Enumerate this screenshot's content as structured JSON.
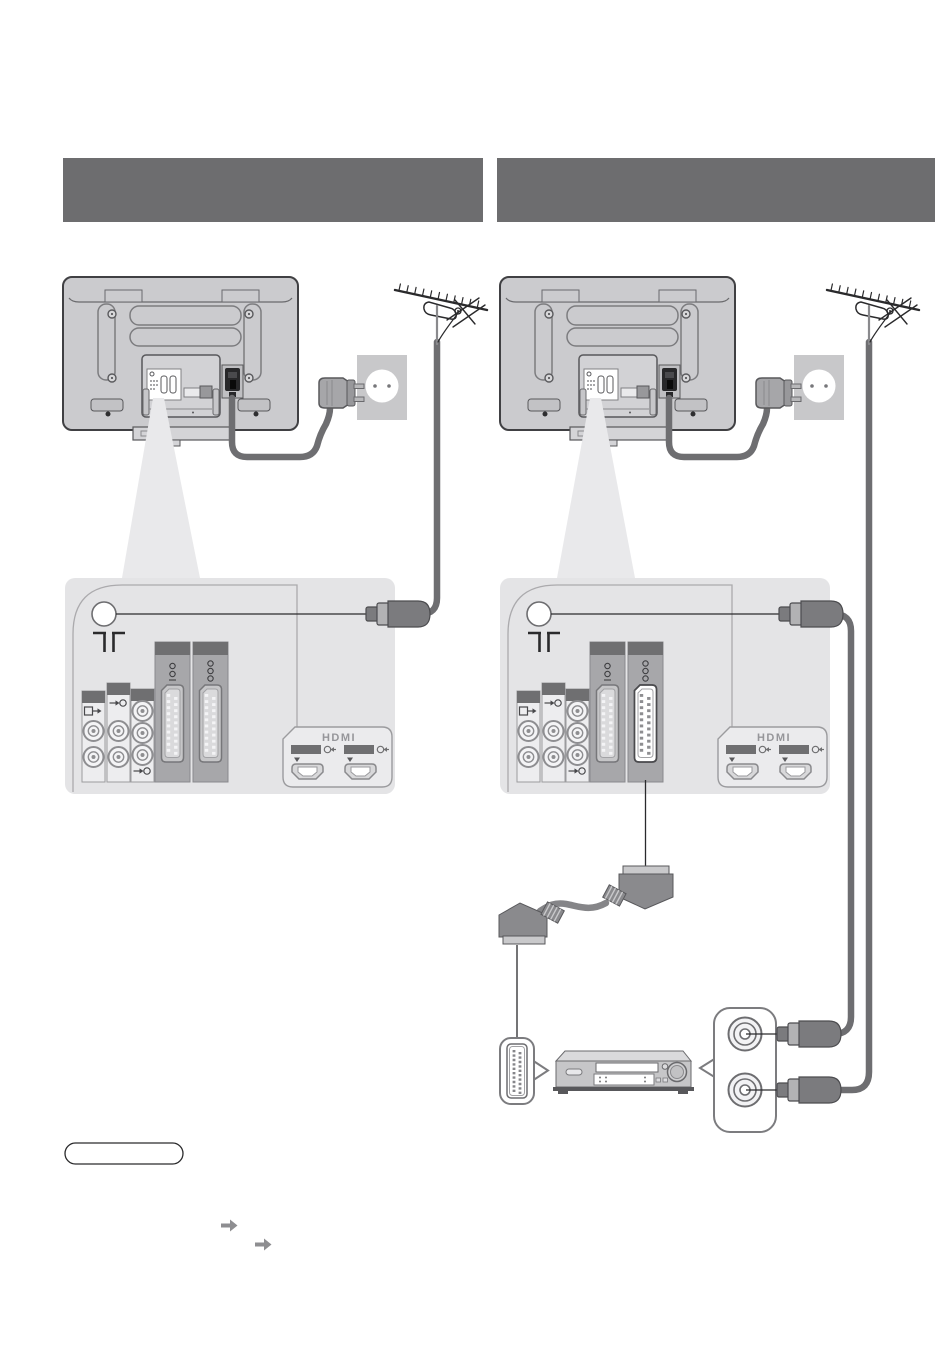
{
  "page": {
    "kind": "tv-manual-connection-diagrams",
    "columns": 2
  },
  "header_bars": {
    "left": {
      "text": ""
    },
    "right": {
      "text": ""
    }
  },
  "labels": {
    "hdmi": "HDMI"
  },
  "colors": {
    "header_bar": "#6d6d6f",
    "tv_body": "#cbcbce",
    "tv_outline": "#404043",
    "panel_bg": "#e4e4e6",
    "beam": "#e9e9eb",
    "connector_header": "#6f6f71",
    "cable": "#6e6e71",
    "scart_highlight_face": "#ffffff",
    "note_outline": "#2a2a2c",
    "arrow_icon": "#8e8e91"
  },
  "icons": {
    "aerial-terminal-symbol": "aerial glyph",
    "av-output-icon": "box with right arrow",
    "av-input-icon": "arrow into circle",
    "hdmi-input-icon": "arrow into circle",
    "down-arrow-marker": "▼",
    "page-reference-arrow": "➡",
    "scart-terminal-icon": "rotated connector glyphs"
  },
  "diagrams": {
    "left": {
      "elements": [
        "tv-rear",
        "aerial-antenna",
        "rf-cable",
        "mains-plug",
        "mains-socket",
        "power-cord",
        "terminal-panel"
      ]
    },
    "right": {
      "elements": [
        "tv-rear",
        "aerial-antenna",
        "rf-cables",
        "mains-plug",
        "mains-socket",
        "power-cord",
        "terminal-panel",
        "scart-cable",
        "dvd-recorder",
        "rf-terminal-callout",
        "scart-callout"
      ]
    }
  },
  "note_box": {
    "text": ""
  }
}
